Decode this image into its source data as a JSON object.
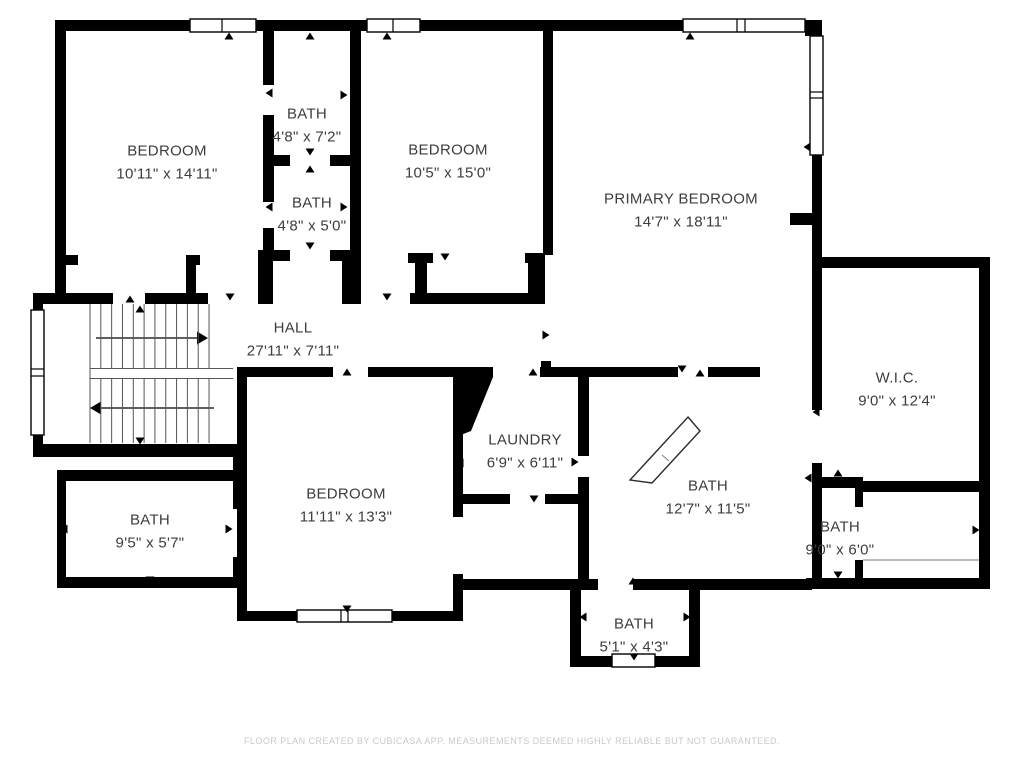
{
  "colors": {
    "wall": "#000000",
    "label_text": "#3d3d3d",
    "footer_text": "#c9c9c9",
    "background": "#ffffff"
  },
  "rooms": [
    {
      "id": "bedroom-top-left",
      "name": "BEDROOM",
      "dims": "10'11\" x 14'11\""
    },
    {
      "id": "bath-upper-middle",
      "name": "BATH",
      "dims": "4'8\" x 7'2\""
    },
    {
      "id": "bath-lower-middle",
      "name": "BATH",
      "dims": "4'8\" x 5'0\""
    },
    {
      "id": "bedroom-top-middle",
      "name": "BEDROOM",
      "dims": "10'5\" x 15'0\""
    },
    {
      "id": "primary-bedroom",
      "name": "PRIMARY BEDROOM",
      "dims": "14'7\" x 18'11\""
    },
    {
      "id": "hall",
      "name": "HALL",
      "dims": "27'11\" x 7'11\""
    },
    {
      "id": "walk-in-closet",
      "name": "W.I.C.",
      "dims": "9'0\" x 12'4\""
    },
    {
      "id": "laundry",
      "name": "LAUNDRY",
      "dims": "6'9\" x 6'11\""
    },
    {
      "id": "bath-ensuite",
      "name": "BATH",
      "dims": "12'7\" x 11'5\""
    },
    {
      "id": "bath-right",
      "name": "BATH",
      "dims": "9'0\" x 6'0\""
    },
    {
      "id": "bedroom-bottom",
      "name": "BEDROOM",
      "dims": "11'11\" x 13'3\""
    },
    {
      "id": "bath-bottom-left",
      "name": "BATH",
      "dims": "9'5\" x 5'7\""
    },
    {
      "id": "bath-small-bottom",
      "name": "BATH",
      "dims": "5'1\" x 4'3\""
    }
  ],
  "footer": "FLOOR PLAN CREATED BY CUBICASA APP. MEASUREMENTS DEEMED HIGHLY RELIABLE BUT NOT GUARANTEED."
}
